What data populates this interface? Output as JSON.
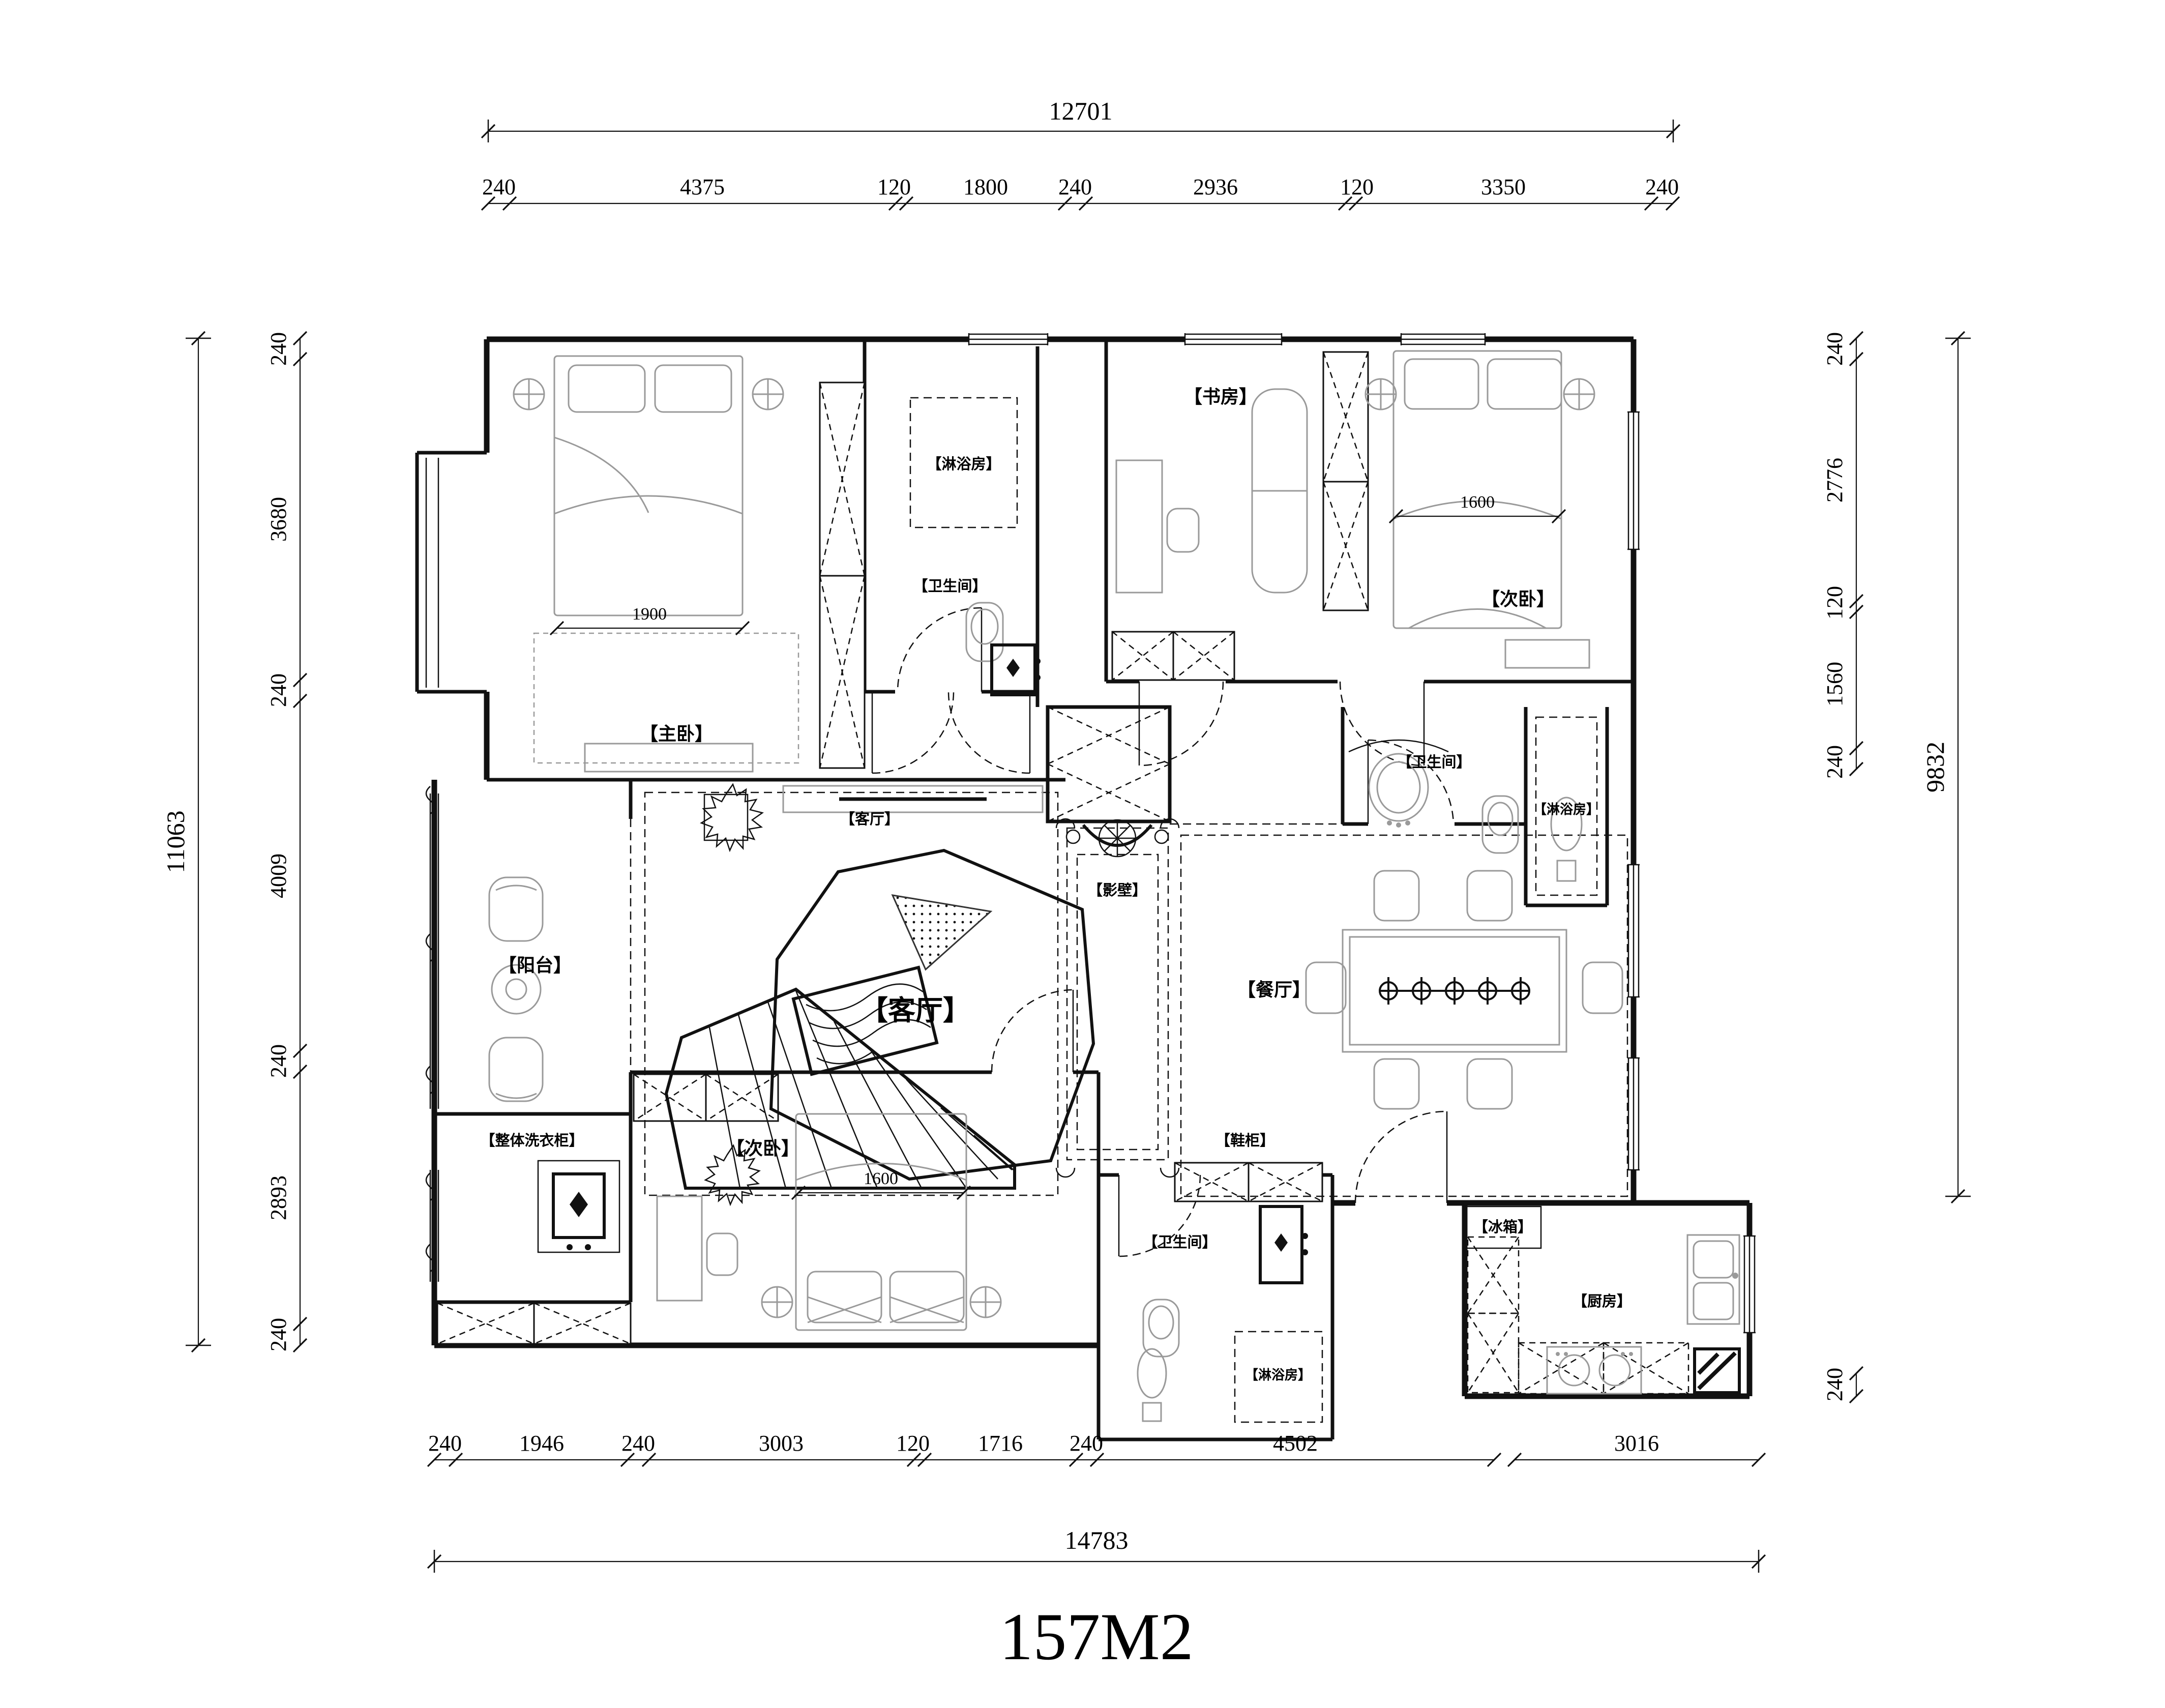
{
  "title": {
    "area_label": "157M2"
  },
  "colors": {
    "wall": "#111111",
    "furniture": "#9a9a9a",
    "background": "#ffffff"
  },
  "rooms": {
    "master_bedroom": "【主卧】",
    "shower_top": "【淋浴房】",
    "bath_top": "【卫生间】",
    "study": "【书房】",
    "bedroom2_top": "【次卧】",
    "bath_right": "【卫生间】",
    "shower_right": "【淋浴房】",
    "living_small": "【客厅】",
    "living_big": "【客厅】",
    "balcony": "【阳台】",
    "screen_wall": "【影壁】",
    "dining": "【餐厅】",
    "shoe_cabinet": "【鞋柜】",
    "laundry": "【整体洗衣柜】",
    "bedroom_bottom": "【次卧】",
    "bath_bottom": "【卫生间】",
    "shower_bottom": "【淋浴房】",
    "fridge": "【冰箱】",
    "kitchen": "【厨房】"
  },
  "inner_dims": {
    "master_bed_width": "1900",
    "bedroom2_bed_width": "1600",
    "bedroom_bottom_bed_width": "1600"
  },
  "dims": {
    "top_total": "12701",
    "top_chain": [
      "240",
      "4375",
      "120",
      "1800",
      "240",
      "2936",
      "120",
      "3350",
      "240"
    ],
    "left_total": "11063",
    "left_chain": [
      "240",
      "3680",
      "240",
      "4009",
      "240",
      "2893",
      "240"
    ],
    "right_total": "9832",
    "right_chain": [
      "240",
      "2776",
      "120",
      "1560",
      "240"
    ],
    "right_kitchen_240": "240",
    "bottom_chain": [
      "240",
      "1946",
      "240",
      "3003",
      "120",
      "1716",
      "240",
      "4502",
      "3016"
    ],
    "bottom_total": "14783"
  }
}
